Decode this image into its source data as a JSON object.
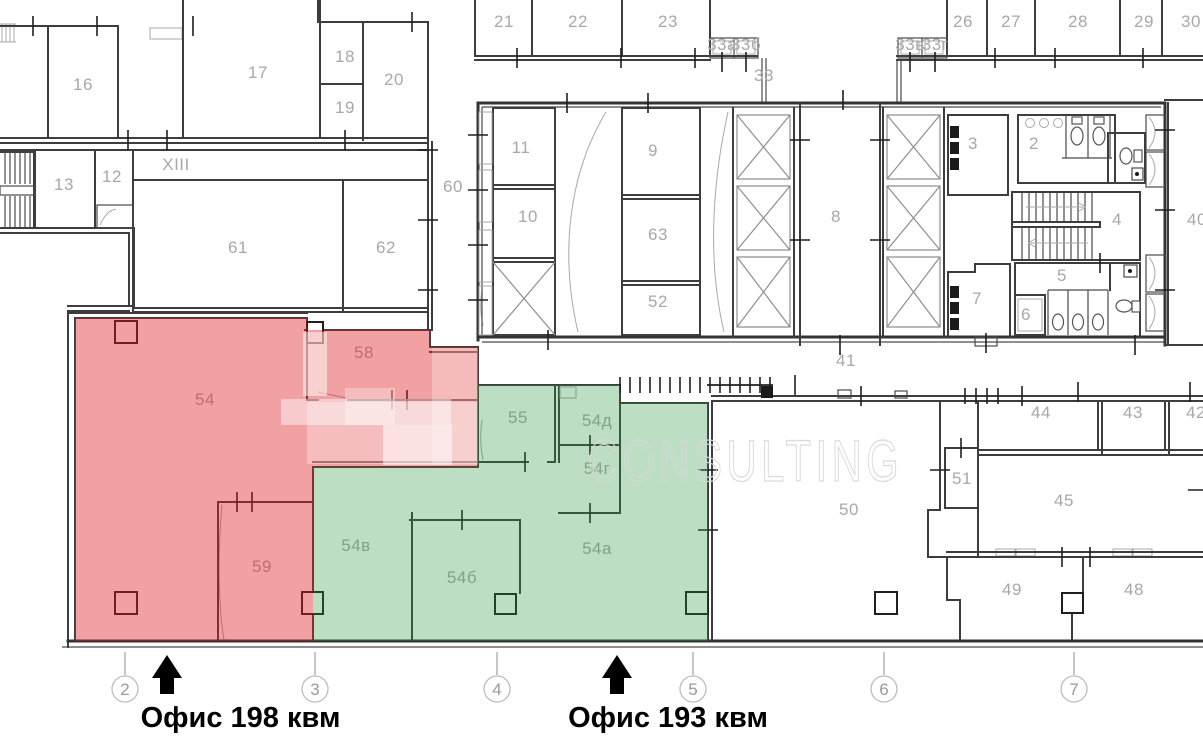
{
  "captions": {
    "office_red": "Офис 198 квм",
    "office_green": "Офис 193 квм"
  },
  "watermark": "CONSULTING",
  "colors": {
    "highlight_red": "rgba(221,32,32,0.42)",
    "highlight_green": "rgba(40,148,60,0.31)",
    "wall": "#3d3d3d",
    "room_label": "#a8a8a8",
    "axis": "#9a9a9a"
  },
  "rooms": [
    {
      "t": "16",
      "x": 83,
      "y": 90
    },
    {
      "t": "17",
      "x": 258,
      "y": 78
    },
    {
      "t": "18",
      "x": 345,
      "y": 62
    },
    {
      "t": "19",
      "x": 345,
      "y": 113
    },
    {
      "t": "20",
      "x": 394,
      "y": 85
    },
    {
      "t": "21",
      "x": 504,
      "y": 27
    },
    {
      "t": "22",
      "x": 578,
      "y": 27
    },
    {
      "t": "23",
      "x": 668,
      "y": 27
    },
    {
      "t": "33а",
      "x": 722,
      "y": 50,
      "s": 7.5
    },
    {
      "t": "33б",
      "x": 746,
      "y": 50,
      "s": 7.5
    },
    {
      "t": "33",
      "x": 764,
      "y": 81
    },
    {
      "t": "33в",
      "x": 910,
      "y": 50,
      "s": 7.5
    },
    {
      "t": "33г",
      "x": 935,
      "y": 50,
      "s": 7.5
    },
    {
      "t": "26",
      "x": 963,
      "y": 27
    },
    {
      "t": "27",
      "x": 1011,
      "y": 27
    },
    {
      "t": "28",
      "x": 1078,
      "y": 27
    },
    {
      "t": "29",
      "x": 1144,
      "y": 27
    },
    {
      "t": "30",
      "x": 1191,
      "y": 27
    },
    {
      "t": "13",
      "x": 64,
      "y": 190
    },
    {
      "t": "12",
      "x": 112,
      "y": 182
    },
    {
      "t": "XIII",
      "x": 176,
      "y": 170,
      "s": 15
    },
    {
      "t": "61",
      "x": 238,
      "y": 253
    },
    {
      "t": "62",
      "x": 386,
      "y": 253
    },
    {
      "t": "60",
      "x": 453,
      "y": 192
    },
    {
      "t": "11",
      "x": 521,
      "y": 153
    },
    {
      "t": "10",
      "x": 528,
      "y": 222
    },
    {
      "t": "9",
      "x": 653,
      "y": 156
    },
    {
      "t": "63",
      "x": 658,
      "y": 240
    },
    {
      "t": "52",
      "x": 658,
      "y": 307
    },
    {
      "t": "8",
      "x": 836,
      "y": 222
    },
    {
      "t": "3",
      "x": 973,
      "y": 149
    },
    {
      "t": "2",
      "x": 1034,
      "y": 149
    },
    {
      "t": "4",
      "x": 1117,
      "y": 225
    },
    {
      "t": "40",
      "x": 1197,
      "y": 225
    },
    {
      "t": "5",
      "x": 1062,
      "y": 281
    },
    {
      "t": "6",
      "x": 1026,
      "y": 320
    },
    {
      "t": "7",
      "x": 977,
      "y": 304
    },
    {
      "t": "41",
      "x": 846,
      "y": 366
    },
    {
      "t": "54",
      "x": 205,
      "y": 405
    },
    {
      "t": "58",
      "x": 364,
      "y": 358
    },
    {
      "t": "59",
      "x": 262,
      "y": 572
    },
    {
      "t": "55",
      "x": 518,
      "y": 423
    },
    {
      "t": "54д",
      "x": 597,
      "y": 426
    },
    {
      "t": "54г",
      "x": 597,
      "y": 474
    },
    {
      "t": "54в",
      "x": 356,
      "y": 551
    },
    {
      "t": "54б",
      "x": 462,
      "y": 583
    },
    {
      "t": "54а",
      "x": 597,
      "y": 554
    },
    {
      "t": "50",
      "x": 849,
      "y": 515
    },
    {
      "t": "51",
      "x": 962,
      "y": 484
    },
    {
      "t": "44",
      "x": 1041,
      "y": 418
    },
    {
      "t": "43",
      "x": 1133,
      "y": 418
    },
    {
      "t": "42",
      "x": 1196,
      "y": 418
    },
    {
      "t": "45",
      "x": 1064,
      "y": 506
    },
    {
      "t": "49",
      "x": 1012,
      "y": 595
    },
    {
      "t": "48",
      "x": 1134,
      "y": 595
    }
  ],
  "axes": [
    {
      "label": "2",
      "x": 125
    },
    {
      "label": "3",
      "x": 315
    },
    {
      "label": "4",
      "x": 497
    },
    {
      "label": "5",
      "x": 693
    },
    {
      "label": "6",
      "x": 884
    },
    {
      "label": "7",
      "x": 1074
    }
  ]
}
